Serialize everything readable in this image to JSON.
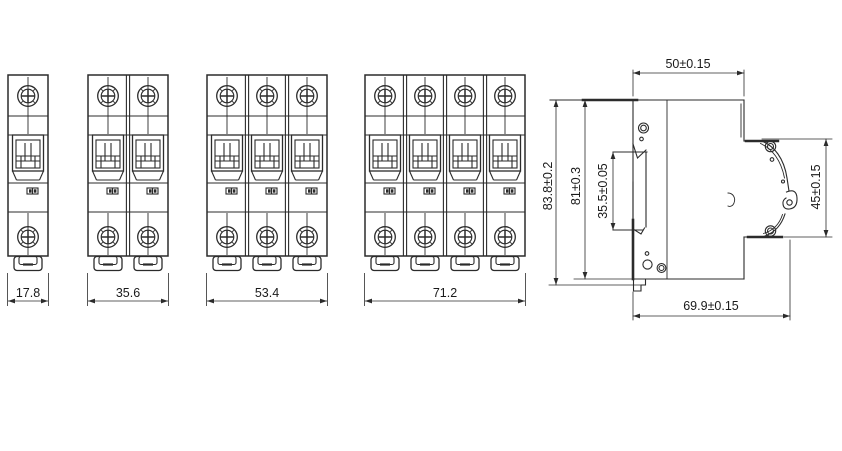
{
  "drawing": {
    "type": "technical-dimension-drawing",
    "subject": "miniature circuit breaker outline drawing",
    "line_color": "#2b2b2b",
    "text_color": "#1a1a1a",
    "front_views": [
      {
        "name": "1-pole front view",
        "poles": 1,
        "width_label": "17.8"
      },
      {
        "name": "2-pole front view",
        "poles": 2,
        "width_label": "35.6"
      },
      {
        "name": "3-pole front view",
        "poles": 3,
        "width_label": "53.4"
      },
      {
        "name": "4-pole front view",
        "poles": 4,
        "width_label": "71.2"
      }
    ],
    "side_view": {
      "width_label": "50±0.15",
      "overall_height_label": "83.8±0.2",
      "body_height_label": "81±0.3",
      "din_recess_label": "35.5±0.05",
      "front_face_height_label": "45±0.15",
      "depth_label": "69.9±0.15"
    }
  }
}
